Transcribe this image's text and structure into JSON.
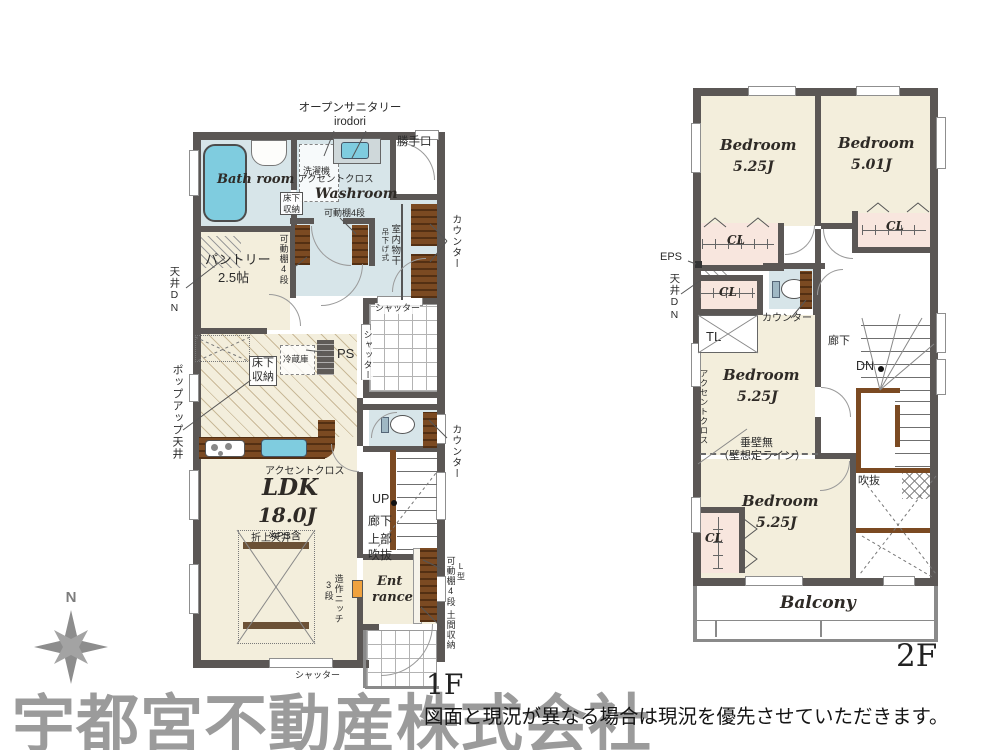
{
  "page": {
    "watermark": "宇都宮不動産株式会社",
    "disclaimer": "図面と現況が異なる場合は現況を優先させていただきます。",
    "compass_n": "N"
  },
  "floor1": {
    "floor_label": "1F",
    "open_sanitary_line1": "オープンサニタリー",
    "open_sanitary_line2": "irodori",
    "back_door": "勝手口",
    "bath_room": "Bath room",
    "washer": "洗濯機",
    "accent_cloth": "アクセントクロス",
    "washroom": "Washroom",
    "floor_storage_line1": "床下",
    "floor_storage_line2": "収納",
    "shelf_4": "可動棚4段",
    "pantry_line1": "パントリー",
    "pantry_line2": "2.5帖",
    "ceiling_dn": "天井DN",
    "popup_ceiling": "ポップアップ天井",
    "fridge": "冷蔵庫",
    "ps": "PS",
    "shutter": "シャッター",
    "counter": "カウンター",
    "indoor_drying": "室内物干",
    "hanging_type": "吊下げ式",
    "ldk": "LDK",
    "ldk_size": "18.0J",
    "ldk_note": "※PS含",
    "coffered_ceiling": "折上天井",
    "niche": "造作ニッチ",
    "niche_steps": "3段",
    "up": "UP",
    "hallway": "廊下",
    "void_upper_line1": "上部",
    "void_upper_line2": "吹抜",
    "entrance_line1": "Ent",
    "entrance_line2": "rance",
    "l_shape": "L型",
    "doma_storage": "土間収納"
  },
  "floor2": {
    "floor_label": "2F",
    "bedroom": "Bedroom",
    "size_525": "5.25J",
    "size_501": "5.01J",
    "cl": "CL",
    "eps": "EPS",
    "ceiling_dn": "天井DN",
    "counter": "カウンター",
    "tl": "TL",
    "hallway": "廊下",
    "dn": "DN",
    "accent_cloth": "アクセントクロス",
    "no_hanging_wall_line1": "垂壁無",
    "no_hanging_wall_line2": "（壁想定ライン）",
    "void": "吹抜",
    "balcony": "Balcony"
  },
  "colors": {
    "wall": "#5b5755",
    "room_floor": "#f3eedc",
    "wet_floor": "#d7e5e9",
    "closet_floor": "#f8e6de",
    "counter_wood": "#7b4a22",
    "fixture_blue": "#7fccdf",
    "niche_orange": "#f0a23e",
    "watermark_gray": "#9b9b9b"
  }
}
